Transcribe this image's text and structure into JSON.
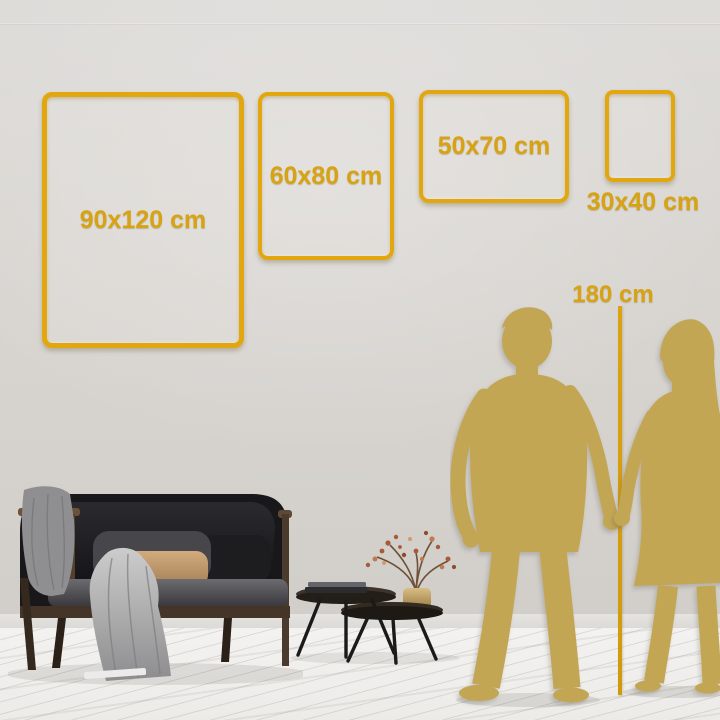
{
  "size_guide": {
    "frames": [
      {
        "id": "frame-90x120",
        "label": "90x120 cm"
      },
      {
        "id": "frame-60x80",
        "label": "60x80 cm"
      },
      {
        "id": "frame-50x70",
        "label": "50x70 cm"
      },
      {
        "id": "frame-30x40",
        "label": "30x40 cm"
      }
    ],
    "height_reference": {
      "label": "180 cm"
    }
  },
  "colors": {
    "accent_gold_text": "#d7a315",
    "frame_border_gold": "#e2a70e",
    "silhouette_gold": "#c3a654",
    "wall_gray": "#d6d3cf",
    "floor_white": "#f1f0ee"
  },
  "scene": {
    "objects": [
      "couple-silhouette",
      "height-reference-line",
      "sofa",
      "throw-blanket",
      "pillows",
      "coffee-tables",
      "books",
      "vase-with-dried-plant"
    ]
  }
}
